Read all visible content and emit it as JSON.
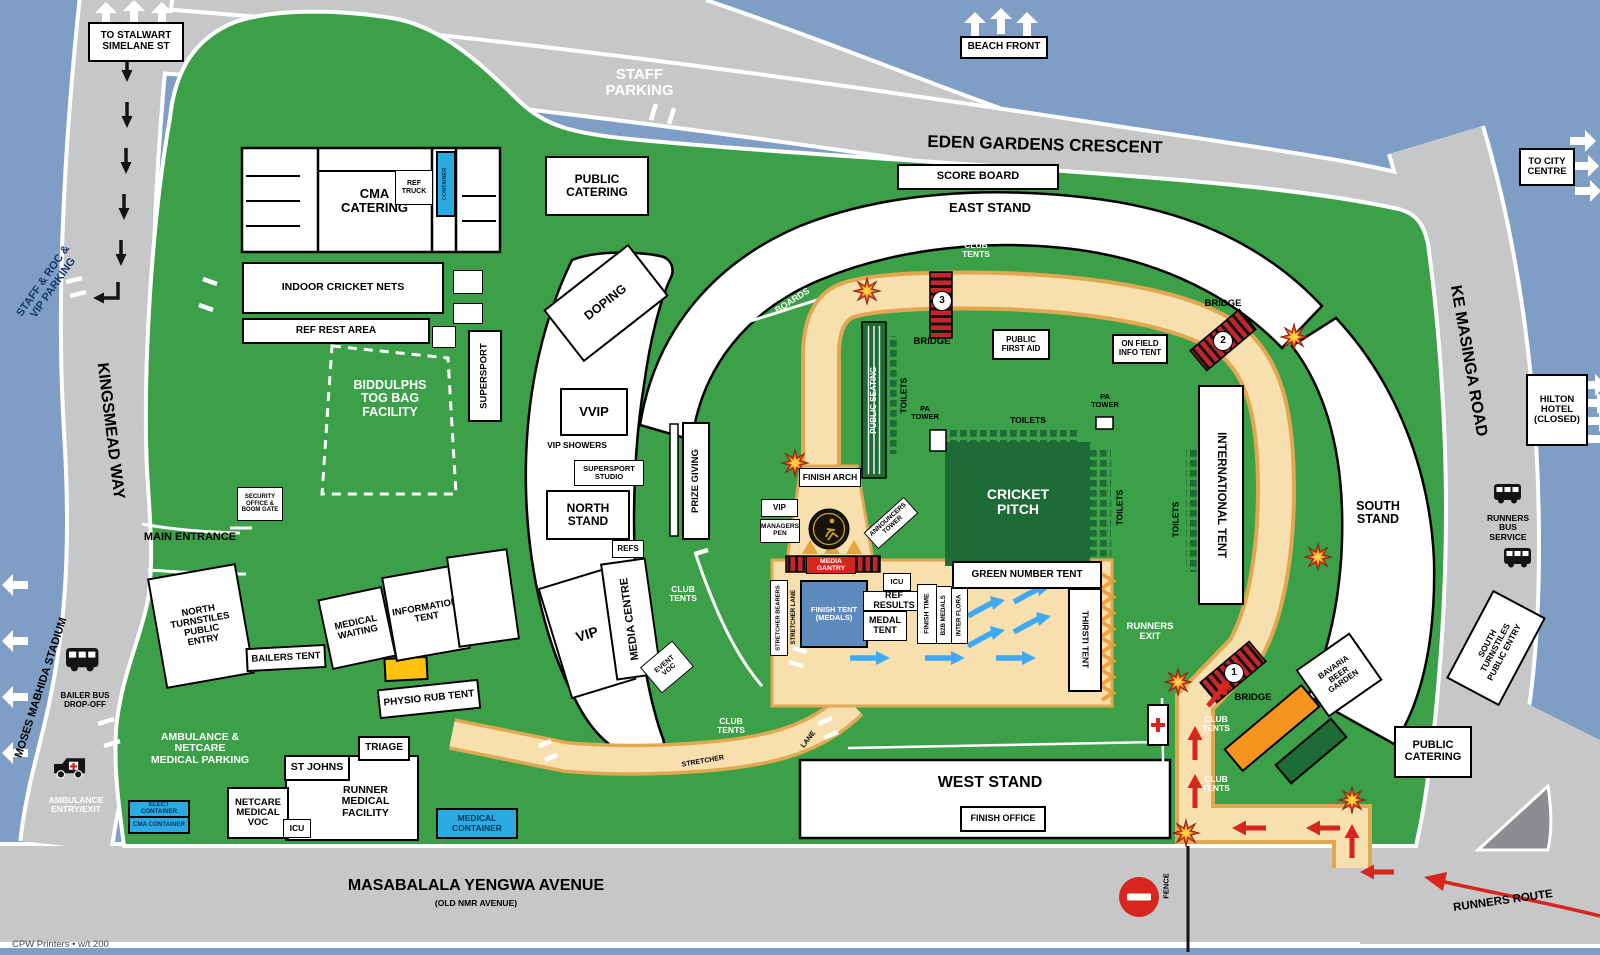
{
  "canvas": {
    "width": 1600,
    "height": 955
  },
  "colors": {
    "water": "#7E9EC6",
    "road": "#C6C7C9",
    "grass": "#3BA047",
    "dark_green": "#1D6B35",
    "path_fill": "#F7DFAE",
    "path_edge": "#E2A851",
    "red": "#D7261E",
    "container_blue": "#29ABE2",
    "tent_blue": "#5E8BBE",
    "yellow": "#FFC20E",
    "orange": "#F7941D"
  },
  "roads": {
    "eden": "EDEN GARDENS CRESCENT",
    "ke_masinga": "KE MASINGA ROAD",
    "kingsmead": "KINGSMEAD WAY",
    "masabalala": "MASABALALA YENGWA AVENUE",
    "masabalala_sub": "(OLD NMR AVENUE)"
  },
  "signs": {
    "to_stalwart": "TO STALWART\nSIMELANE ST",
    "staff_parking": "STAFF\nPARKING",
    "beach_front": "BEACH FRONT",
    "to_city": "TO CITY\nCENTRE",
    "hilton": "HILTON\nHOTEL\n(CLOSED)",
    "moses": "MOSES MABHIDA STADIUM",
    "staff_roc": "STAFF & ROC &\nVIP PARKING",
    "runners_route": "RUNNERS ROUTE",
    "runners_bus": "RUNNERS\nBUS\nSERVICE",
    "bailer_bus": "BAILER BUS\nDROP-OFF",
    "ambulance_entry": "AMBULANCE\nENTRY/EXIT",
    "fence": "FENCE",
    "main_entrance": "MAIN ENTRANCE"
  },
  "stands": {
    "east": "EAST STAND",
    "west": "WEST STAND",
    "north": "NORTH\nSTAND",
    "south": "SOUTH\nSTAND",
    "score_board": "SCORE BOARD",
    "finish_office": "FINISH OFFICE"
  },
  "venue": {
    "public_catering": "PUBLIC\nCATERING",
    "cma_catering": "CMA\nCATERING",
    "ref_truck": "REF\nTRUCK",
    "container": "CONTAINER",
    "indoor_nets": "INDOOR CRICKET NETS",
    "ref_rest": "REF REST AREA",
    "supersport": "SUPERSPORT",
    "biddulphs": "BIDDULPHS\nTOG BAG\nFACILITY",
    "security": "SECURITY\nOFFICE &\nBOOM GATE",
    "doping": "DOPING",
    "vvip": "VVIP",
    "vip": "VIP",
    "vip_showers": "VIP SHOWERS",
    "supersport_studio": "SUPERSPORT\nSTUDIO",
    "refs": "REFS",
    "prize_giving": "PRIZE GIVING",
    "media_centre": "MEDIA CENTRE",
    "event_voc": "EVENT\nVOC",
    "club_tents": "CLUB\nTENTS",
    "advertising": "ADVERTISING\nBOARDS",
    "bridge": "BRIDGE",
    "bridge1": "1",
    "bridge2": "2",
    "bridge3": "3",
    "public_seating": "PUBLIC SEATING",
    "toilets": "TOILETS",
    "pa_tower": "PA\nTOWER",
    "cricket_pitch": "CRICKET\nPITCH",
    "public_first_aid": "PUBLIC\nFIRST AID",
    "on_field_info": "ON FIELD\nINFO TENT",
    "international": "INTERNATIONAL TENT",
    "bavaria": "BAVARIA\nBEER\nGARDEN",
    "south_turnstiles": "SOUTH\nTURNSTILES\nPUBLIC ENTRY",
    "north_turnstiles": "NORTH\nTURNSTILES\nPUBLIC\nENTRY"
  },
  "finish": {
    "arch": "FINISH ARCH",
    "vip": "VIP",
    "managers_pen": "MANAGERS\nPEN",
    "announcers": "ANNOUNCERS\nTOWER",
    "media_gantry": "MEDIA GANTRY",
    "stretcher_bearers": "STRETCHER BEARERS",
    "stretcher_lane": "STRETCHER LANE",
    "stretcher": "STRETCHER",
    "lane": "LANE",
    "tent": "FINISH TENT\n(MEDALS)",
    "icu": "ICU",
    "ref_results": "REF RESULTS",
    "medal_tent": "MEDAL\nTENT",
    "finish_time": "FINISH TIME",
    "b2b": "B2B MEDALS",
    "inter_flora": "INTER FLORA",
    "green_number": "GREEN NUMBER TENT",
    "thirsti": "THIRSTI TENT",
    "runners_exit": "RUNNERS\nEXIT"
  },
  "medical": {
    "parking": "AMBULANCE & NETCARE\nMEDICAL PARKING",
    "bailers": "BAILERS TENT",
    "waiting": "MEDICAL\nWAITING",
    "info_tent": "INFORMATION\nTENT",
    "physio": "PHYSIO RUB TENT",
    "triage": "TRIAGE",
    "st_johns": "ST JOHNS",
    "runner_facility": "RUNNER\nMEDICAL\nFACILITY",
    "netcare_voc": "NETCARE\nMEDICAL\nVOC",
    "icu": "ICU",
    "elect_container": "ELECT CONTAINER",
    "cma_container": "CMA CONTAINER",
    "medical_container": "MEDICAL\nCONTAINER"
  },
  "credit": "CPW Printers • w/t 200",
  "icons": [
    "block-arrow-up-icon",
    "block-arrow-right-icon",
    "block-arrow-left-icon",
    "road-arrow-down-icon",
    "turn-left-arrow-icon",
    "red-route-arrow-icon",
    "blue-flow-arrow-icon",
    "chevron-icon",
    "starburst-marker-icon",
    "bridge-icon",
    "bus-icon",
    "ambulance-icon",
    "first-aid-cross-icon",
    "no-entry-icon",
    "comrades-logo-icon",
    "gate-icon",
    "fence-line-icon"
  ]
}
